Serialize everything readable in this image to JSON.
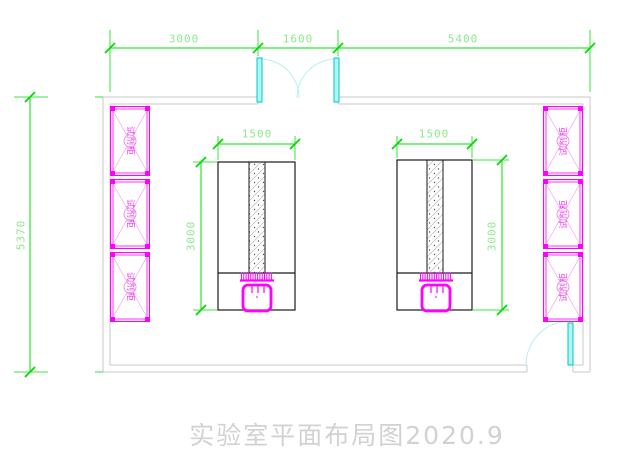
{
  "drawing": {
    "title": "实验室平面布局图2020.9"
  },
  "dimensions": {
    "top_row": [
      {
        "value": "3000"
      },
      {
        "value": "1600"
      },
      {
        "value": "5400"
      }
    ],
    "left_wall": {
      "value": "5370"
    },
    "left_bench": {
      "width": "1500",
      "depth": "3000"
    },
    "right_bench": {
      "width": "1500",
      "depth": "3000"
    }
  },
  "cabinets": {
    "left": [
      {
        "label": "试剂柜"
      },
      {
        "label": "试剂柜"
      },
      {
        "label": "试剂柜"
      }
    ],
    "right": [
      {
        "label": "试剂柜"
      },
      {
        "label": "试剂柜"
      },
      {
        "label": "试剂柜"
      }
    ]
  },
  "colors": {
    "dimension_line": "#00dd00",
    "dimension_text": "#8fe88f",
    "furniture": "#ff00ff",
    "door": "#00e0e0",
    "wall": "#c9c9c9",
    "bench_outline": "#1a1a1a",
    "title_text": "#d2d2d2"
  }
}
